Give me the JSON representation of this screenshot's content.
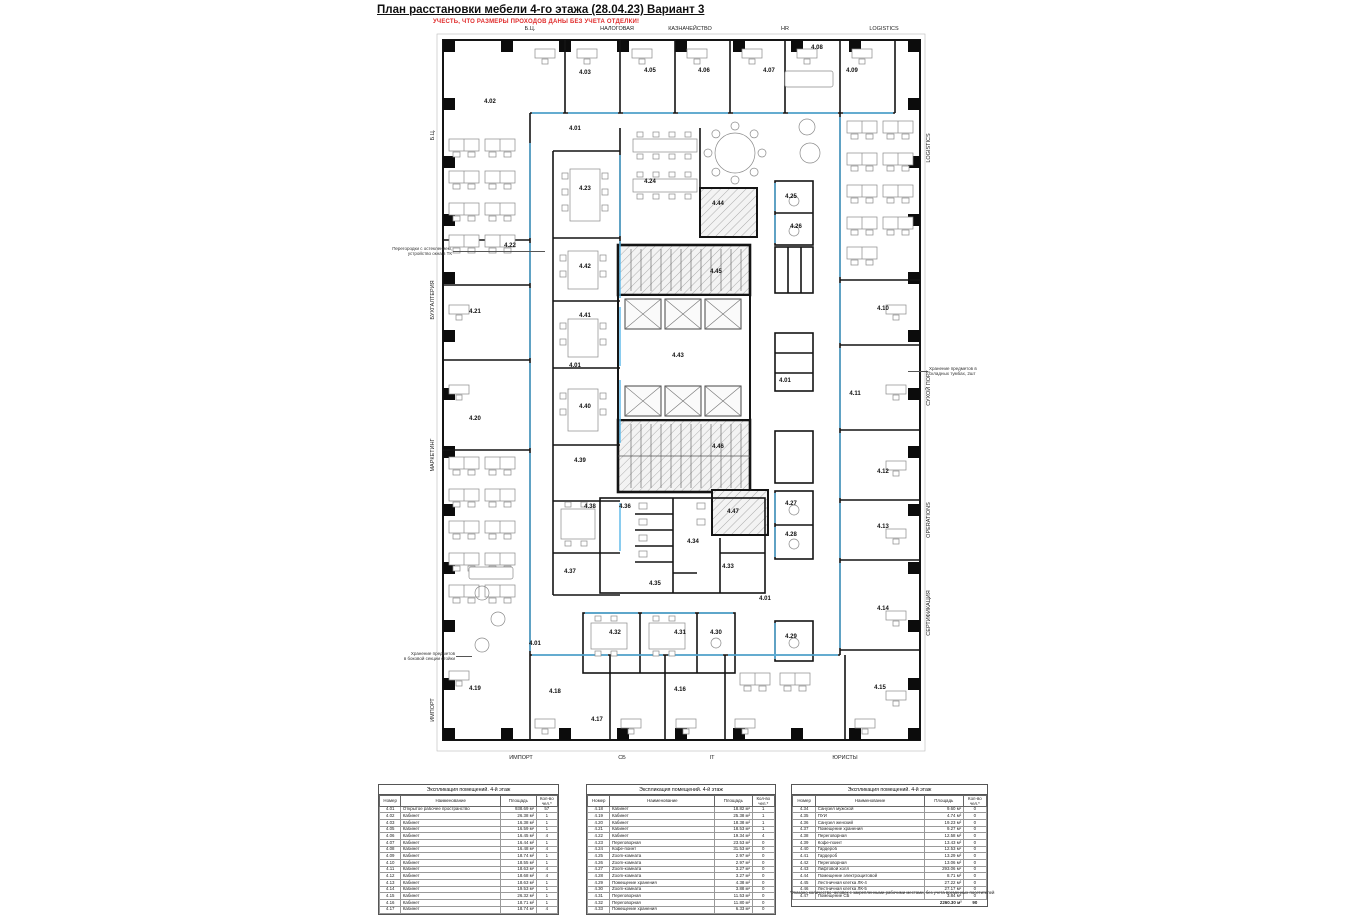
{
  "header": {
    "title": "План расстановки мебели 4-го этажа (28.04.23) Вариант 3",
    "warning": "УЧЕСТЬ, ЧТО РАЗМЕРЫ ПРОХОДОВ ДАНЫ БЕЗ УЧЕТА ОТДЕЛКИ!"
  },
  "colors": {
    "accent_blue": "#58b7e8",
    "warning_red": "#e02b2b",
    "wall": "#141414",
    "hatch_gray": "#9b9b9b"
  },
  "plan": {
    "zones": {
      "top": [
        {
          "t": "Б.Ц.",
          "x": 530
        },
        {
          "t": "НАЛОГОВАЯ",
          "x": 617
        },
        {
          "t": "КАЗНАЧЕЙСТВО",
          "x": 690
        },
        {
          "t": "HR",
          "x": 785
        },
        {
          "t": "LOGISTICS",
          "x": 884
        }
      ],
      "bottom": [
        {
          "t": "ИМПОРТ",
          "x": 521
        },
        {
          "t": "СБ",
          "x": 622
        },
        {
          "t": "IT",
          "x": 712
        },
        {
          "t": "ЮРИСТЫ",
          "x": 845
        }
      ],
      "left": [
        {
          "t": "Б.Ц.",
          "y": 135
        },
        {
          "t": "БУХГАЛТЕРИЯ",
          "y": 300
        },
        {
          "t": "МАРКЕТИНГ",
          "y": 455
        },
        {
          "t": "ИМПОРТ",
          "y": 710
        }
      ],
      "right": [
        {
          "t": "LOGISTICS",
          "y": 148
        },
        {
          "t": "СУХОЙ ПОРТ",
          "y": 388
        },
        {
          "t": "OPERATIONS",
          "y": 520
        },
        {
          "t": "СЕРТИФИКАЦИЯ",
          "y": 613
        }
      ]
    },
    "rooms": [
      {
        "id": "4.02",
        "x": 55,
        "y": 70
      },
      {
        "id": "4.03",
        "x": 150,
        "y": 41
      },
      {
        "id": "4.05",
        "x": 215,
        "y": 39
      },
      {
        "id": "4.06",
        "x": 269,
        "y": 39
      },
      {
        "id": "4.07",
        "x": 334,
        "y": 39
      },
      {
        "id": "4.08",
        "x": 382,
        "y": 16
      },
      {
        "id": "4.09",
        "x": 417,
        "y": 39
      },
      {
        "id": "4.01",
        "x": 140,
        "y": 97
      },
      {
        "id": "4.01",
        "x": 140,
        "y": 334
      },
      {
        "id": "4.01",
        "x": 350,
        "y": 349
      },
      {
        "id": "4.01",
        "x": 330,
        "y": 567
      },
      {
        "id": "4.01",
        "x": 100,
        "y": 612
      },
      {
        "id": "4.23",
        "x": 150,
        "y": 157
      },
      {
        "id": "4.24",
        "x": 215,
        "y": 150
      },
      {
        "id": "4.44",
        "x": 283,
        "y": 172
      },
      {
        "id": "4.25",
        "x": 356,
        "y": 165
      },
      {
        "id": "4.26",
        "x": 361,
        "y": 195
      },
      {
        "id": "4.22",
        "x": 75,
        "y": 214
      },
      {
        "id": "4.42",
        "x": 150,
        "y": 235
      },
      {
        "id": "4.45",
        "x": 281,
        "y": 240
      },
      {
        "id": "4.21",
        "x": 40,
        "y": 280
      },
      {
        "id": "4.41",
        "x": 150,
        "y": 284
      },
      {
        "id": "4.10",
        "x": 448,
        "y": 277
      },
      {
        "id": "4.43",
        "x": 243,
        "y": 324
      },
      {
        "id": "4.20",
        "x": 40,
        "y": 387
      },
      {
        "id": "4.40",
        "x": 150,
        "y": 375
      },
      {
        "id": "4.11",
        "x": 420,
        "y": 362
      },
      {
        "id": "4.39",
        "x": 145,
        "y": 429
      },
      {
        "id": "4.46",
        "x": 283,
        "y": 415
      },
      {
        "id": "4.12",
        "x": 448,
        "y": 440
      },
      {
        "id": "4.38",
        "x": 155,
        "y": 475
      },
      {
        "id": "4.36",
        "x": 190,
        "y": 475
      },
      {
        "id": "4.47",
        "x": 298,
        "y": 480
      },
      {
        "id": "4.27",
        "x": 356,
        "y": 472
      },
      {
        "id": "4.13",
        "x": 448,
        "y": 495
      },
      {
        "id": "4.34",
        "x": 258,
        "y": 510
      },
      {
        "id": "4.28",
        "x": 356,
        "y": 503
      },
      {
        "id": "4.37",
        "x": 135,
        "y": 540
      },
      {
        "id": "4.35",
        "x": 220,
        "y": 552
      },
      {
        "id": "4.33",
        "x": 293,
        "y": 535
      },
      {
        "id": "4.14",
        "x": 448,
        "y": 577
      },
      {
        "id": "4.32",
        "x": 180,
        "y": 601
      },
      {
        "id": "4.31",
        "x": 245,
        "y": 601
      },
      {
        "id": "4.30",
        "x": 281,
        "y": 601
      },
      {
        "id": "4.29",
        "x": 356,
        "y": 605
      },
      {
        "id": "4.19",
        "x": 40,
        "y": 657
      },
      {
        "id": "4.18",
        "x": 120,
        "y": 660
      },
      {
        "id": "4.16",
        "x": 245,
        "y": 658
      },
      {
        "id": "4.15",
        "x": 445,
        "y": 656
      },
      {
        "id": "4.17",
        "x": 162,
        "y": 688
      }
    ],
    "annotations": [
      {
        "t": "Перегородки с остеклением,\nустройство окна в ТК",
        "x": 452,
        "y": 246,
        "align": "right",
        "lead": [
          453,
          251,
          92
        ]
      },
      {
        "t": "Хранение предметов\nв боковой секции стойки",
        "x": 455,
        "y": 651,
        "align": "right",
        "lead": [
          456,
          656,
          16
        ]
      },
      {
        "t": "Хранение предметов в\nскладных тумбах, 2шт",
        "x": 929,
        "y": 366,
        "align": "left",
        "lead": [
          908,
          371,
          20
        ]
      }
    ]
  },
  "tables": [
    {
      "title": "Экспликация помещений. 4-й этаж",
      "columns": [
        "Номер",
        "Наименование",
        "Площадь",
        "Кол-во чел.*"
      ],
      "rows": [
        [
          "4.01",
          "Открытое рабочее пространство",
          "938.69 м²",
          "57"
        ],
        [
          "4.02",
          "Кабинет",
          "26.38 м²",
          "1"
        ],
        [
          "4.03",
          "Кабинет",
          "16.38 м²",
          "1"
        ],
        [
          "4.05",
          "Кабинет",
          "16.59 м²",
          "1"
        ],
        [
          "4.06",
          "Кабинет",
          "16.45 м²",
          "4"
        ],
        [
          "4.07",
          "Кабинет",
          "16.44 м²",
          "1"
        ],
        [
          "4.08",
          "Кабинет",
          "16.48 м²",
          "4"
        ],
        [
          "4.09",
          "Кабинет",
          "18.74 м²",
          "1"
        ],
        [
          "4.10",
          "Кабинет",
          "18.55 м²",
          "1"
        ],
        [
          "4.11",
          "Кабинет",
          "18.63 м²",
          "4"
        ],
        [
          "4.12",
          "Кабинет",
          "18.68 м²",
          "4"
        ],
        [
          "4.13",
          "Кабинет",
          "18.63 м²",
          "1"
        ],
        [
          "4.14",
          "Кабинет",
          "19.53 м²",
          "1"
        ],
        [
          "4.15",
          "Кабинет",
          "26.32 м²",
          "1"
        ],
        [
          "4.16",
          "Кабинет",
          "18.71 м²",
          "1"
        ],
        [
          "4.17",
          "Кабинет",
          "18.74 м²",
          "4"
        ]
      ]
    },
    {
      "title": "Экспликация помещений. 4-й этаж",
      "columns": [
        "Номер",
        "Наименование",
        "Площадь",
        "Кол-во чел.*"
      ],
      "rows": [
        [
          "4.18",
          "Кабинет",
          "18.82 м²",
          "1"
        ],
        [
          "4.19",
          "Кабинет",
          "25.38 м²",
          "1"
        ],
        [
          "4.20",
          "Кабинет",
          "18.38 м²",
          "1"
        ],
        [
          "4.21",
          "Кабинет",
          "18.53 м²",
          "1"
        ],
        [
          "4.22",
          "Кабинет",
          "19.34 м²",
          "4"
        ],
        [
          "4.23",
          "Переговорная",
          "23.53 м²",
          "0"
        ],
        [
          "4.24",
          "Кофе-поинт",
          "31.53 м²",
          "0"
        ],
        [
          "4.25",
          "Zoom-комната",
          "2.97 м²",
          "0"
        ],
        [
          "4.26",
          "Zoom-комната",
          "2.97 м²",
          "0"
        ],
        [
          "4.27",
          "Zoom-комната",
          "3.27 м²",
          "0"
        ],
        [
          "4.28",
          "Zoom-комната",
          "3.27 м²",
          "0"
        ],
        [
          "4.29",
          "Помещение хранения",
          "4.38 м²",
          "0"
        ],
        [
          "4.30",
          "Zoom-комната",
          "3.88 м²",
          "0"
        ],
        [
          "4.31",
          "Переговорная",
          "11.53 м²",
          "0"
        ],
        [
          "4.32",
          "Переговорная",
          "11.80 м²",
          "0"
        ],
        [
          "4.33",
          "Помещение хранения",
          "6.33 м²",
          "0"
        ]
      ]
    },
    {
      "title": "Экспликация помещений. 4-й этаж",
      "columns": [
        "Номер",
        "Наименование",
        "Площадь",
        "Кол-во чел.*"
      ],
      "rows": [
        [
          "4.34",
          "Санузел мужской",
          "9.60 м²",
          "0"
        ],
        [
          "4.35",
          "ПУИ",
          "4.74 м²",
          "0"
        ],
        [
          "4.36",
          "Санузел женский",
          "19.23 м²",
          "0"
        ],
        [
          "4.37",
          "Помещение хранения",
          "9.27 м²",
          "0"
        ],
        [
          "4.38",
          "Переговорная",
          "12.58 м²",
          "0"
        ],
        [
          "4.39",
          "Кофе-поинт",
          "13.43 м²",
          "0"
        ],
        [
          "4.40",
          "Гардероб",
          "12.53 м²",
          "0"
        ],
        [
          "4.41",
          "Гардероб",
          "13.29 м²",
          "0"
        ],
        [
          "4.42",
          "Переговорная",
          "13.06 м²",
          "0"
        ],
        [
          "4.43",
          "Лифтовой холл",
          "293.06 м²",
          "0"
        ],
        [
          "4.44",
          "Помещение электрощитовой",
          "8.71 м²",
          "0"
        ],
        [
          "4.45",
          "Лестничная клетка ЛК-4",
          "27.22 м²",
          "0"
        ],
        [
          "4.46",
          "Лестничная клетка ЛК-5",
          "27.17 м²",
          "0"
        ],
        [
          "4.47",
          "Помещение СБ",
          "3.84 м²",
          "0"
        ]
      ],
      "total": {
        "area": "2260.30 м²",
        "count": "90"
      }
    }
  ],
  "footnote": "*Указано количество человек с закрепленными рабочими местами, без учета временных посетителей"
}
